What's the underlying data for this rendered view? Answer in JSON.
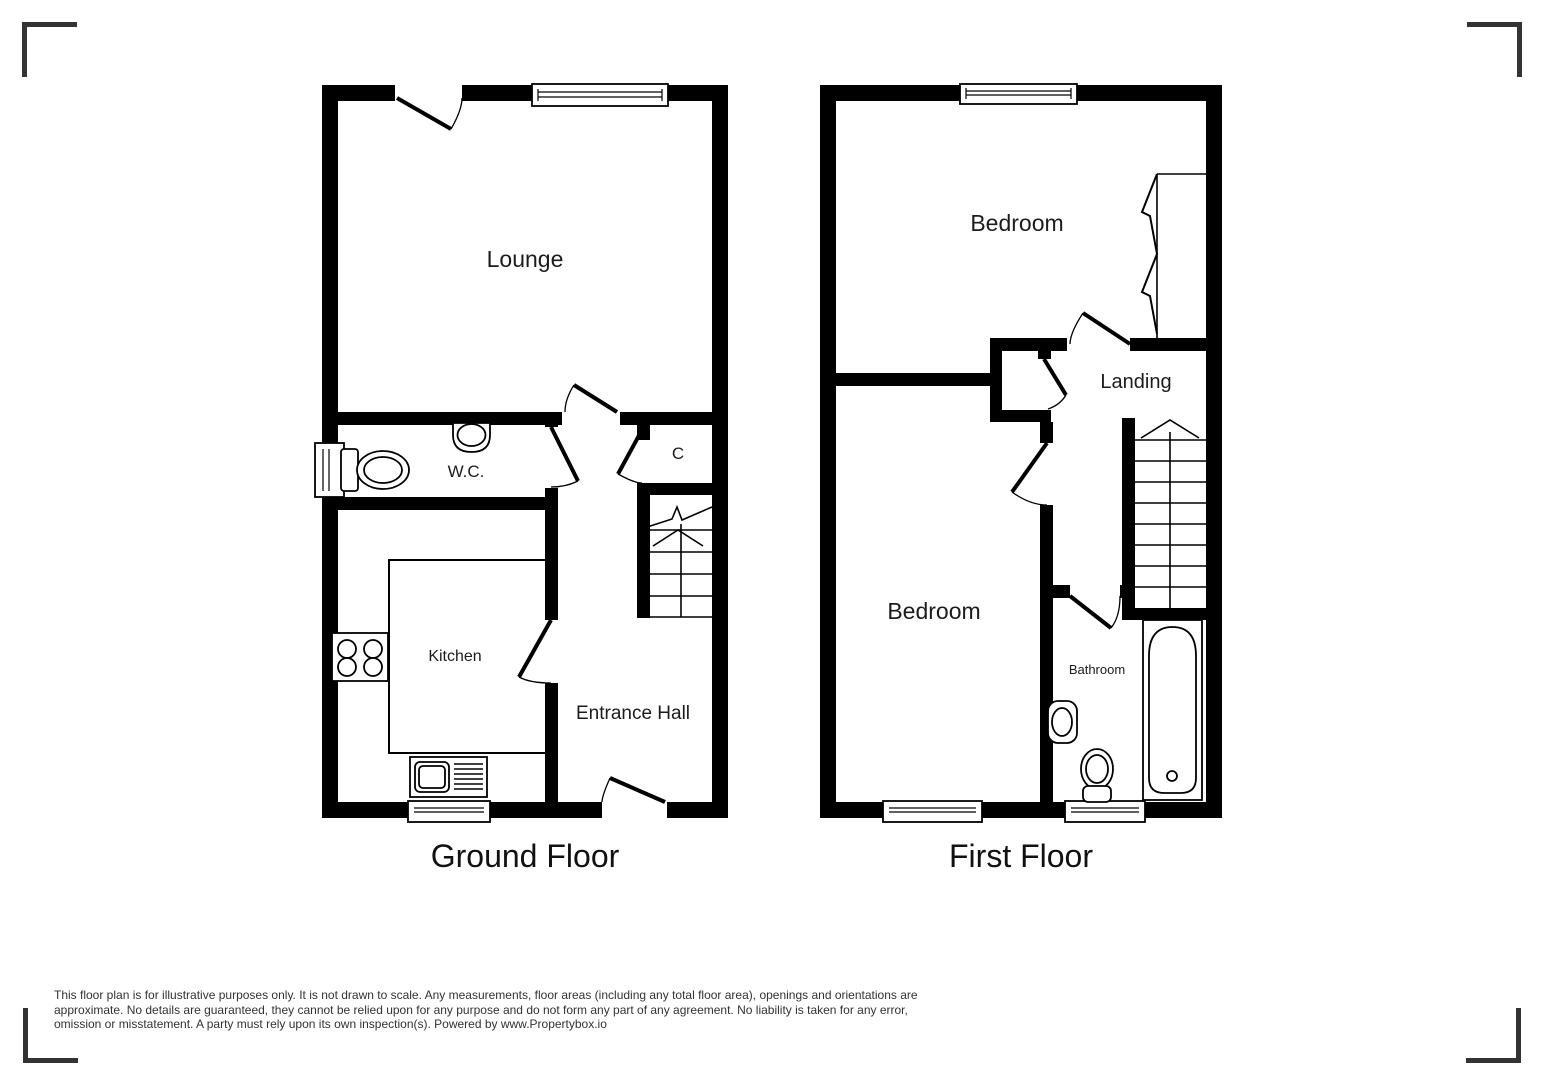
{
  "floors": [
    {
      "title": "Ground Floor",
      "rooms": {
        "lounge": "Lounge",
        "wc": "W.C.",
        "cupboard": "C",
        "kitchen": "Kitchen",
        "hall": "Entrance Hall"
      }
    },
    {
      "title": "First Floor",
      "rooms": {
        "bedroom_top": "Bedroom",
        "landing": "Landing",
        "bedroom_bottom": "Bedroom",
        "bathroom": "Bathroom"
      }
    }
  ],
  "disclaimer": "This floor plan is for illustrative purposes only. It is not drawn to scale. Any measurements, floor areas (including any total floor area), openings and orientations are\napproximate. No details are guaranteed, they cannot be relied upon for any purpose and do not form any part of any agreement. No liability is taken for any error,\nomission or misstatement. A party must rely upon its own inspection(s). Powered by www.Propertybox.io"
}
